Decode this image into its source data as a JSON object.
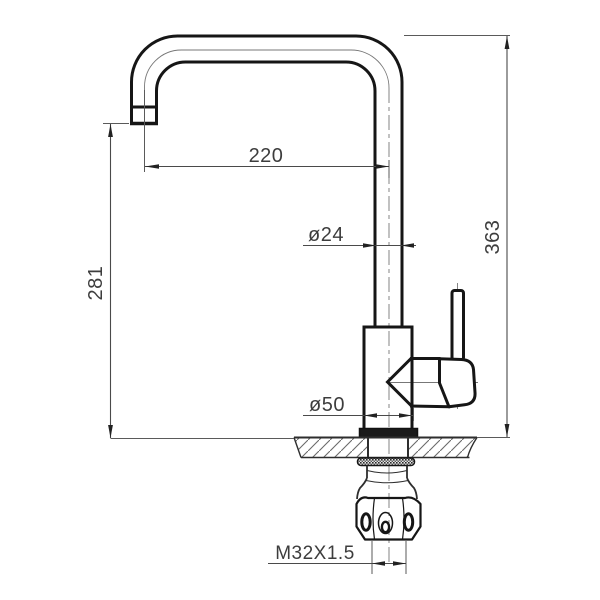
{
  "drawing": {
    "dimensions": {
      "spout_reach": "220",
      "spout_tube_diameter": "ø24",
      "overall_height": "363",
      "spout_outlet_height": "281",
      "base_diameter": "ø50",
      "mounting_thread": "M32X1.5"
    },
    "colors": {
      "outline": "#161616",
      "medium_line": "#2e2e2e",
      "thin_line": "#5a5a5a",
      "dimension_line": "#4a4a4a",
      "text": "#3d3d3d",
      "background": "#ffffff"
    }
  }
}
